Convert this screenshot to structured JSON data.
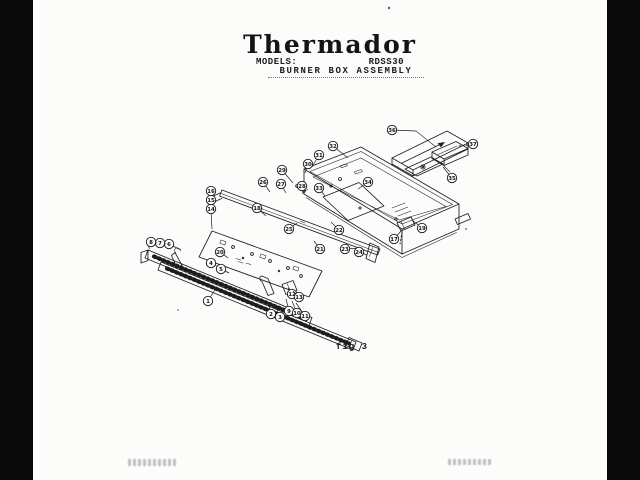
{
  "header": {
    "brand": "Thermador",
    "models_label": "MODELS:",
    "model_number": "RDSS30",
    "subtitle": "BURNER BOX ASSEMBLY"
  },
  "figure": {
    "caption": "fig 3"
  },
  "colors": {
    "ink": "#1d1d1d",
    "paper": "#fcfcfb",
    "scan_border": "#0a0a0a"
  },
  "diagram": {
    "title": "Burner box exploded parts view",
    "balloons": [
      {
        "n": "1",
        "x": 208,
        "y": 301,
        "lx": 216,
        "ly": 288
      },
      {
        "n": "2",
        "x": 271,
        "y": 314,
        "lx": 268,
        "ly": 303
      },
      {
        "n": "3",
        "x": 280,
        "y": 317,
        "lx": 275,
        "ly": 305
      },
      {
        "n": "4",
        "x": 211,
        "y": 263,
        "lx": 220,
        "ly": 268
      },
      {
        "n": "5",
        "x": 221,
        "y": 269,
        "lx": 229,
        "ly": 273
      },
      {
        "n": "6",
        "x": 169,
        "y": 244,
        "lx": 181,
        "ly": 250
      },
      {
        "n": "7",
        "x": 160,
        "y": 243,
        "lx": 166,
        "ly": 244
      },
      {
        "n": "8",
        "x": 151,
        "y": 242,
        "lx": 157,
        "ly": 243
      },
      {
        "n": "9",
        "x": 289,
        "y": 311,
        "lx": 286,
        "ly": 299
      },
      {
        "n": "10",
        "x": 297,
        "y": 313,
        "lx": 292,
        "ly": 301
      },
      {
        "n": "11",
        "x": 305,
        "y": 316,
        "lx": 296,
        "ly": 303
      },
      {
        "n": "12",
        "x": 292,
        "y": 294,
        "lx": 288,
        "ly": 288
      },
      {
        "n": "13",
        "x": 299,
        "y": 297,
        "lx": 293,
        "ly": 291
      },
      {
        "n": "14",
        "x": 211,
        "y": 209,
        "lx": 212,
        "ly": 229
      },
      {
        "n": "15",
        "x": 211,
        "y": 200,
        "lx": 211,
        "ly": 205
      },
      {
        "n": "16",
        "x": 211,
        "y": 191,
        "lx": 211,
        "ly": 196
      },
      {
        "n": "17",
        "x": 394,
        "y": 239,
        "lx": 401,
        "ly": 231
      },
      {
        "n": "18",
        "x": 257,
        "y": 208,
        "lx": 266,
        "ly": 216
      },
      {
        "n": "19",
        "x": 422,
        "y": 228,
        "lx": 412,
        "ly": 220
      },
      {
        "n": "20",
        "x": 220,
        "y": 252,
        "lx": 228,
        "ly": 258
      },
      {
        "n": "21",
        "x": 320,
        "y": 249,
        "lx": 314,
        "ly": 241
      },
      {
        "n": "22",
        "x": 339,
        "y": 230,
        "lx": 331,
        "ly": 222
      },
      {
        "n": "23",
        "x": 345,
        "y": 249,
        "lx": 362,
        "ly": 248
      },
      {
        "n": "24",
        "x": 359,
        "y": 252,
        "lx": 367,
        "ly": 255
      },
      {
        "n": "25",
        "x": 289,
        "y": 229,
        "lx": 297,
        "ly": 223
      },
      {
        "n": "26",
        "x": 263,
        "y": 182,
        "lx": 270,
        "ly": 192
      },
      {
        "n": "27",
        "x": 281,
        "y": 184,
        "lx": 286,
        "ly": 193
      },
      {
        "n": "28",
        "x": 302,
        "y": 186,
        "lx": 303,
        "ly": 194
      },
      {
        "n": "29",
        "x": 282,
        "y": 170,
        "lx": 293,
        "ly": 183
      },
      {
        "n": "30",
        "x": 308,
        "y": 164,
        "lx": 305,
        "ly": 173
      },
      {
        "n": "31",
        "x": 319,
        "y": 155,
        "lx": 312,
        "ly": 167
      },
      {
        "n": "32",
        "x": 333,
        "y": 146,
        "lx": 348,
        "ly": 158
      },
      {
        "n": "33",
        "x": 319,
        "y": 188,
        "lx": 325,
        "ly": 196
      },
      {
        "n": "34",
        "x": 368,
        "y": 182,
        "lx": 358,
        "ly": 189
      },
      {
        "n": "35",
        "x": 452,
        "y": 178,
        "lx": 443,
        "ly": 167
      },
      {
        "n": "36",
        "x": 392,
        "y": 130,
        "lx": 416,
        "ly": 131
      },
      {
        "n": "37",
        "x": 473,
        "y": 144,
        "lx": 466,
        "ly": 145
      }
    ]
  }
}
